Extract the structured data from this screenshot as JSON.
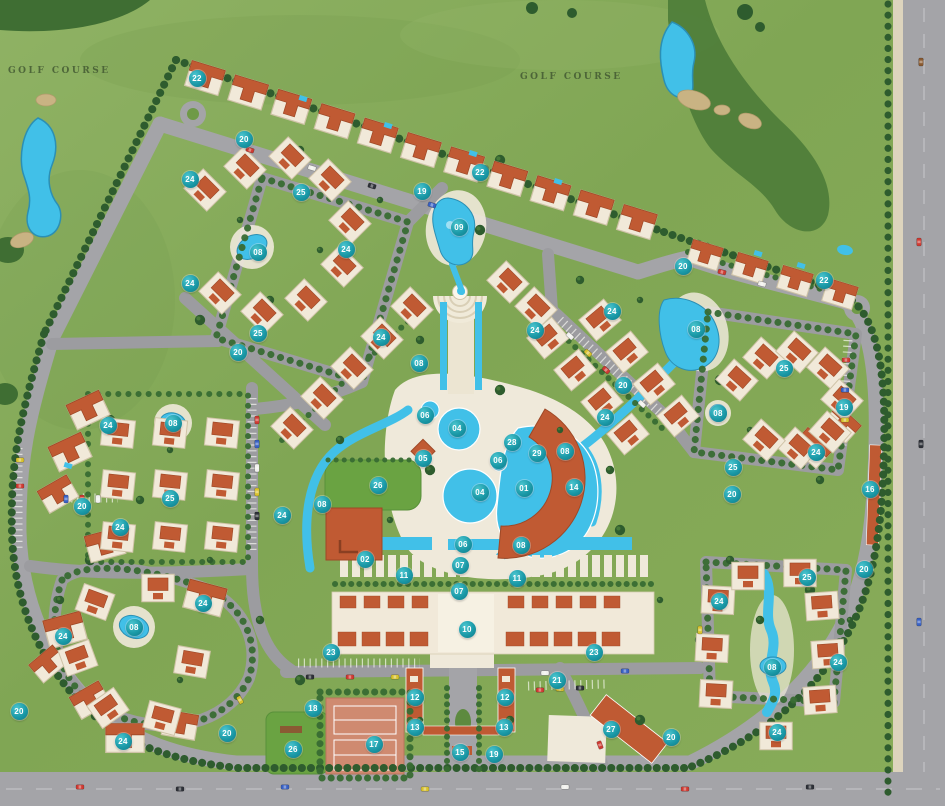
{
  "map": {
    "type": "resort-master-plan",
    "golf_labels": [
      {
        "text": "GOLF COURSE",
        "x": 8,
        "y": 66
      },
      {
        "text": "GOLF COURSE",
        "x": 520,
        "y": 72
      }
    ],
    "palette": {
      "grass": "#85a854",
      "rough": "#4d7c38",
      "water": "#41c0e8",
      "road": "#a4a4a8",
      "sand": "#c9b383",
      "deck": "#efe9da",
      "roof": "#c05a33",
      "building": "#f1e9d9",
      "badge_teal": "#1b9aa8",
      "tree": "#2e5c2e"
    },
    "markers": [
      {
        "n": "22",
        "x": 197,
        "y": 78
      },
      {
        "n": "20",
        "x": 244,
        "y": 139
      },
      {
        "n": "24",
        "x": 190,
        "y": 179
      },
      {
        "n": "25",
        "x": 301,
        "y": 192
      },
      {
        "n": "22",
        "x": 480,
        "y": 172
      },
      {
        "n": "19",
        "x": 422,
        "y": 191
      },
      {
        "n": "09",
        "x": 459,
        "y": 227
      },
      {
        "n": "08",
        "x": 258,
        "y": 252
      },
      {
        "n": "24",
        "x": 346,
        "y": 249
      },
      {
        "n": "24",
        "x": 190,
        "y": 283
      },
      {
        "n": "25",
        "x": 258,
        "y": 333
      },
      {
        "n": "20",
        "x": 238,
        "y": 352
      },
      {
        "n": "24",
        "x": 381,
        "y": 337
      },
      {
        "n": "20",
        "x": 683,
        "y": 266
      },
      {
        "n": "22",
        "x": 824,
        "y": 280
      },
      {
        "n": "08",
        "x": 696,
        "y": 329
      },
      {
        "n": "25",
        "x": 784,
        "y": 368
      },
      {
        "n": "24",
        "x": 612,
        "y": 311
      },
      {
        "n": "24",
        "x": 535,
        "y": 330
      },
      {
        "n": "08",
        "x": 419,
        "y": 363
      },
      {
        "n": "06",
        "x": 425,
        "y": 415
      },
      {
        "n": "04",
        "x": 457,
        "y": 428
      },
      {
        "n": "05",
        "x": 423,
        "y": 458
      },
      {
        "n": "28",
        "x": 512,
        "y": 442
      },
      {
        "n": "29",
        "x": 537,
        "y": 453
      },
      {
        "n": "06",
        "x": 498,
        "y": 460
      },
      {
        "n": "08",
        "x": 565,
        "y": 451
      },
      {
        "n": "24",
        "x": 605,
        "y": 417
      },
      {
        "n": "08",
        "x": 718,
        "y": 413
      },
      {
        "n": "19",
        "x": 844,
        "y": 407
      },
      {
        "n": "24",
        "x": 816,
        "y": 452
      },
      {
        "n": "25",
        "x": 733,
        "y": 467
      },
      {
        "n": "16",
        "x": 870,
        "y": 489
      },
      {
        "n": "20",
        "x": 732,
        "y": 494
      },
      {
        "n": "20",
        "x": 623,
        "y": 385
      },
      {
        "n": "04",
        "x": 480,
        "y": 492
      },
      {
        "n": "01",
        "x": 524,
        "y": 488
      },
      {
        "n": "14",
        "x": 574,
        "y": 487
      },
      {
        "n": "26",
        "x": 378,
        "y": 485
      },
      {
        "n": "08",
        "x": 322,
        "y": 504
      },
      {
        "n": "02",
        "x": 365,
        "y": 559
      },
      {
        "n": "06",
        "x": 463,
        "y": 544
      },
      {
        "n": "08",
        "x": 521,
        "y": 545
      },
      {
        "n": "07",
        "x": 460,
        "y": 565
      },
      {
        "n": "11",
        "x": 404,
        "y": 575
      },
      {
        "n": "11",
        "x": 517,
        "y": 578
      },
      {
        "n": "07",
        "x": 459,
        "y": 591
      },
      {
        "n": "10",
        "x": 467,
        "y": 629
      },
      {
        "n": "24",
        "x": 108,
        "y": 425
      },
      {
        "n": "08",
        "x": 173,
        "y": 423
      },
      {
        "n": "25",
        "x": 170,
        "y": 498
      },
      {
        "n": "20",
        "x": 82,
        "y": 506
      },
      {
        "n": "24",
        "x": 120,
        "y": 527
      },
      {
        "n": "24",
        "x": 282,
        "y": 515
      },
      {
        "n": "24",
        "x": 63,
        "y": 636
      },
      {
        "n": "08",
        "x": 134,
        "y": 627
      },
      {
        "n": "24",
        "x": 203,
        "y": 603
      },
      {
        "n": "24",
        "x": 123,
        "y": 741
      },
      {
        "n": "20",
        "x": 227,
        "y": 733
      },
      {
        "n": "20",
        "x": 19,
        "y": 711
      },
      {
        "n": "23",
        "x": 331,
        "y": 652
      },
      {
        "n": "18",
        "x": 313,
        "y": 708
      },
      {
        "n": "26",
        "x": 293,
        "y": 749
      },
      {
        "n": "17",
        "x": 374,
        "y": 744
      },
      {
        "n": "12",
        "x": 415,
        "y": 697
      },
      {
        "n": "12",
        "x": 505,
        "y": 697
      },
      {
        "n": "13",
        "x": 415,
        "y": 727
      },
      {
        "n": "13",
        "x": 504,
        "y": 727
      },
      {
        "n": "15",
        "x": 460,
        "y": 752
      },
      {
        "n": "19",
        "x": 494,
        "y": 754
      },
      {
        "n": "23",
        "x": 594,
        "y": 652
      },
      {
        "n": "21",
        "x": 557,
        "y": 680
      },
      {
        "n": "27",
        "x": 611,
        "y": 729
      },
      {
        "n": "20",
        "x": 671,
        "y": 737
      },
      {
        "n": "24",
        "x": 719,
        "y": 601
      },
      {
        "n": "25",
        "x": 807,
        "y": 577
      },
      {
        "n": "20",
        "x": 864,
        "y": 569
      },
      {
        "n": "08",
        "x": 772,
        "y": 667
      },
      {
        "n": "24",
        "x": 838,
        "y": 662
      },
      {
        "n": "24",
        "x": 777,
        "y": 732
      }
    ]
  }
}
